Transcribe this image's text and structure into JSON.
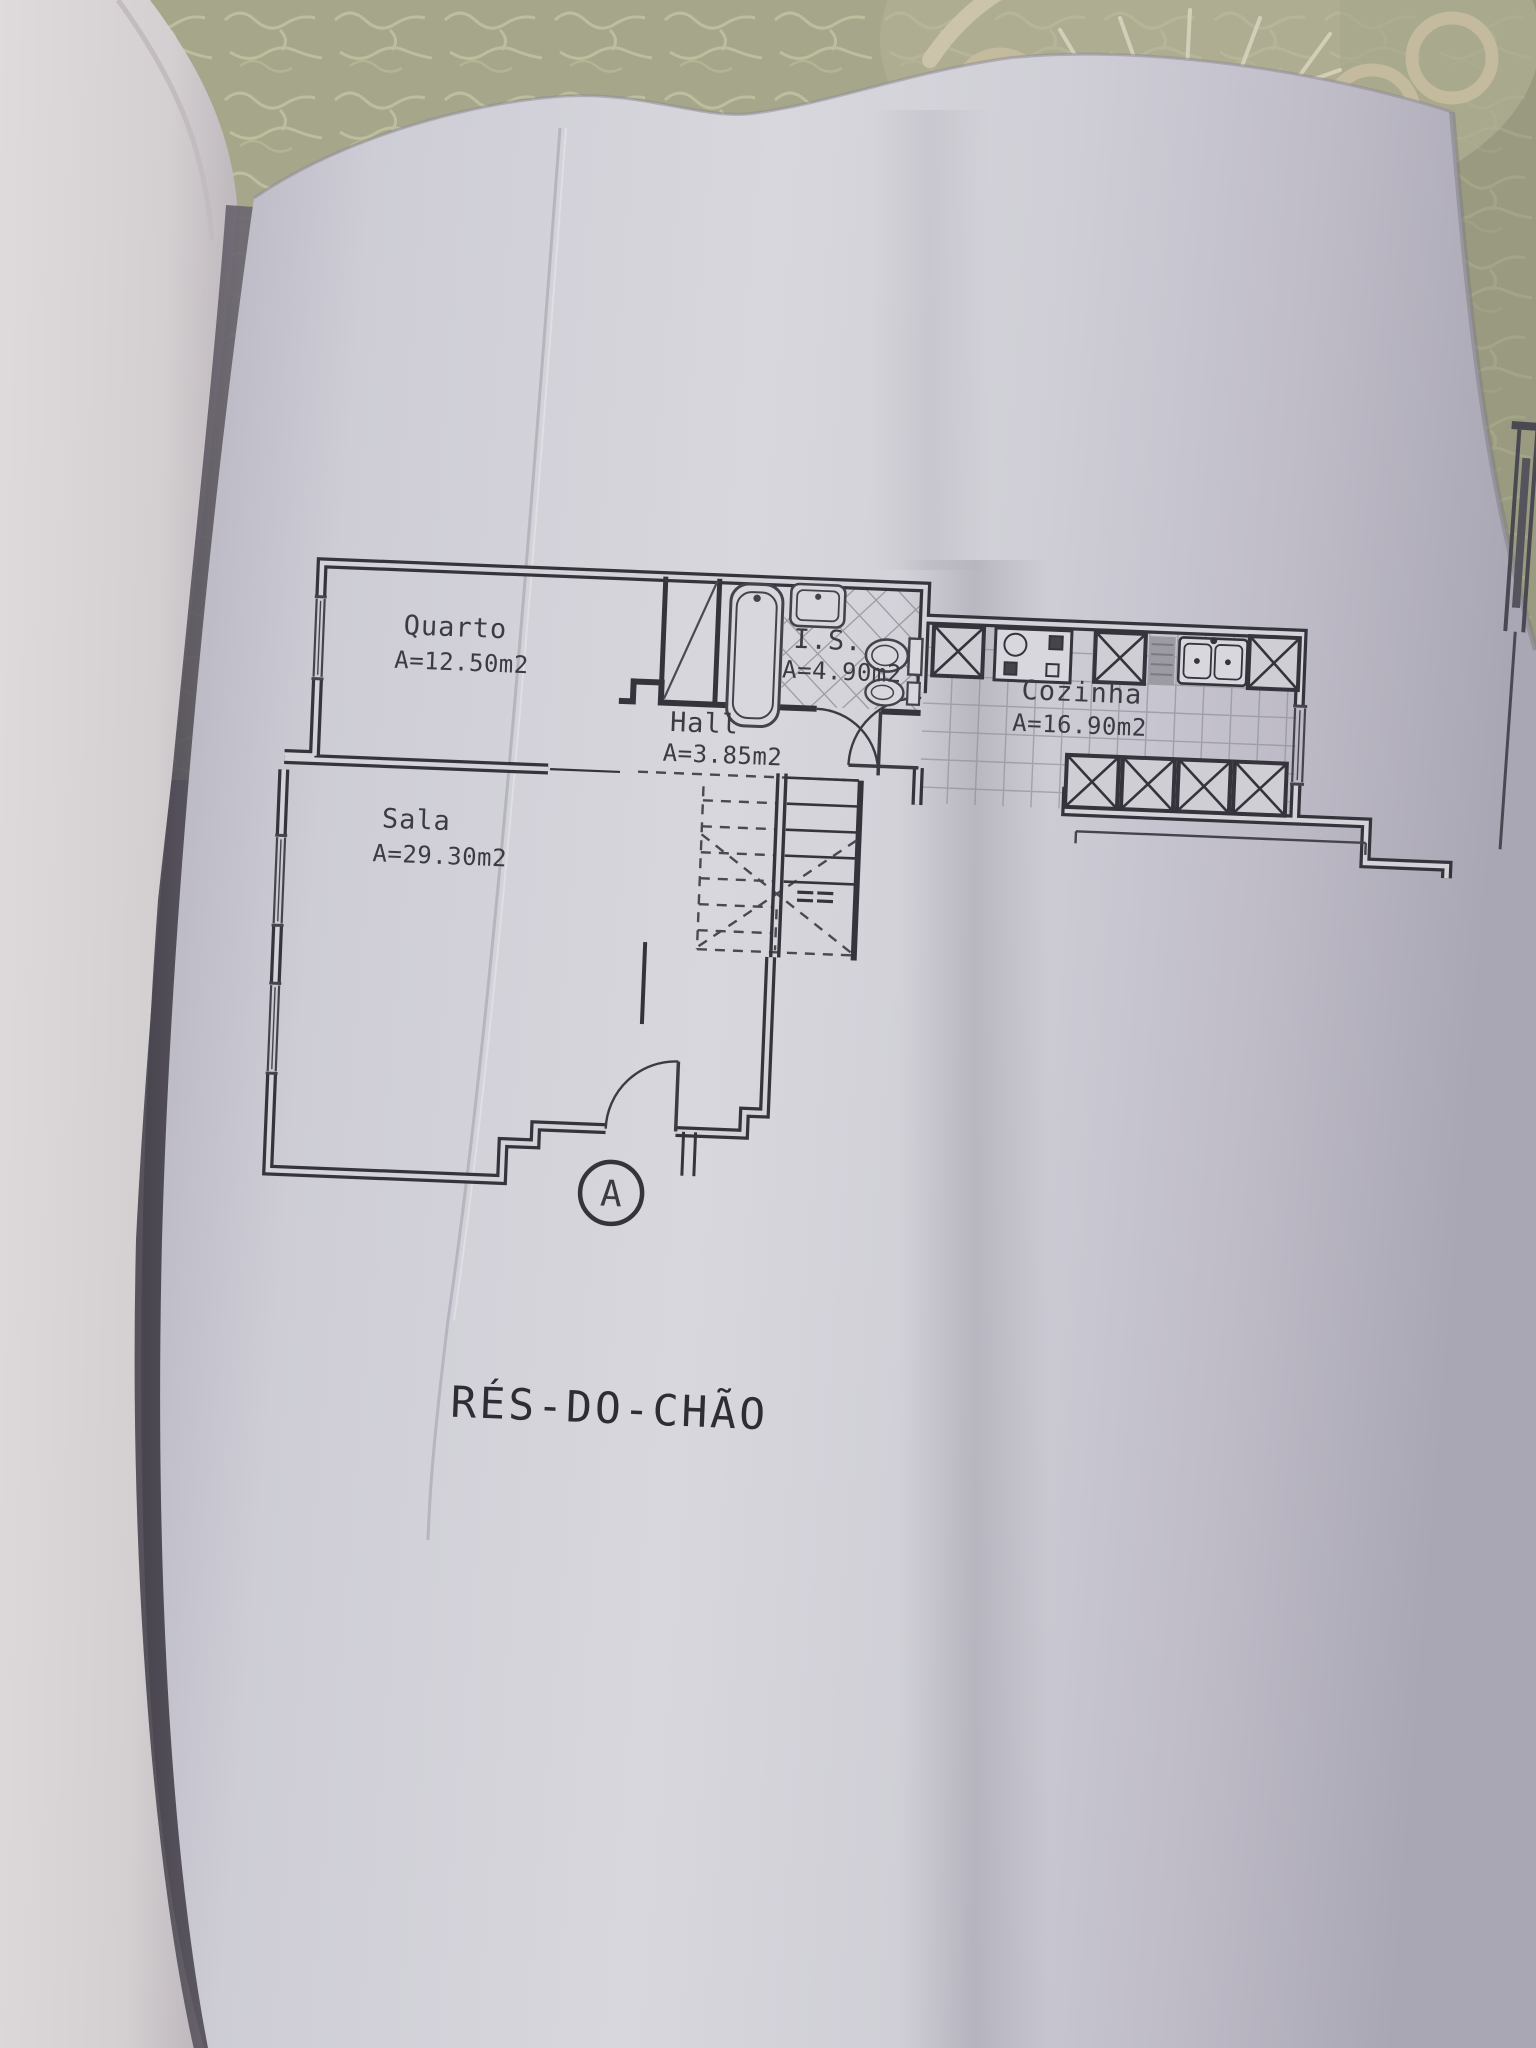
{
  "plan": {
    "title": "RÉS-DO-CHÃO",
    "section_marker": "A",
    "rooms": {
      "quarto": {
        "name": "Quarto",
        "area": "A=12.50m2"
      },
      "sala": {
        "name": "Sala",
        "area": "A=29.30m2"
      },
      "hall": {
        "name": "Hall",
        "area": "A=3.85m2"
      },
      "is": {
        "name": "I.S.",
        "area": "A=4.90m2"
      },
      "cozinha": {
        "name": "Cozinha",
        "area": "A=16.90m2"
      }
    }
  },
  "photo": {
    "tablecloth_color": "#a5a68a",
    "doily_color": "#c4ba9d",
    "paper_color": "#d2d1d8",
    "ink_color": "#35343c"
  }
}
